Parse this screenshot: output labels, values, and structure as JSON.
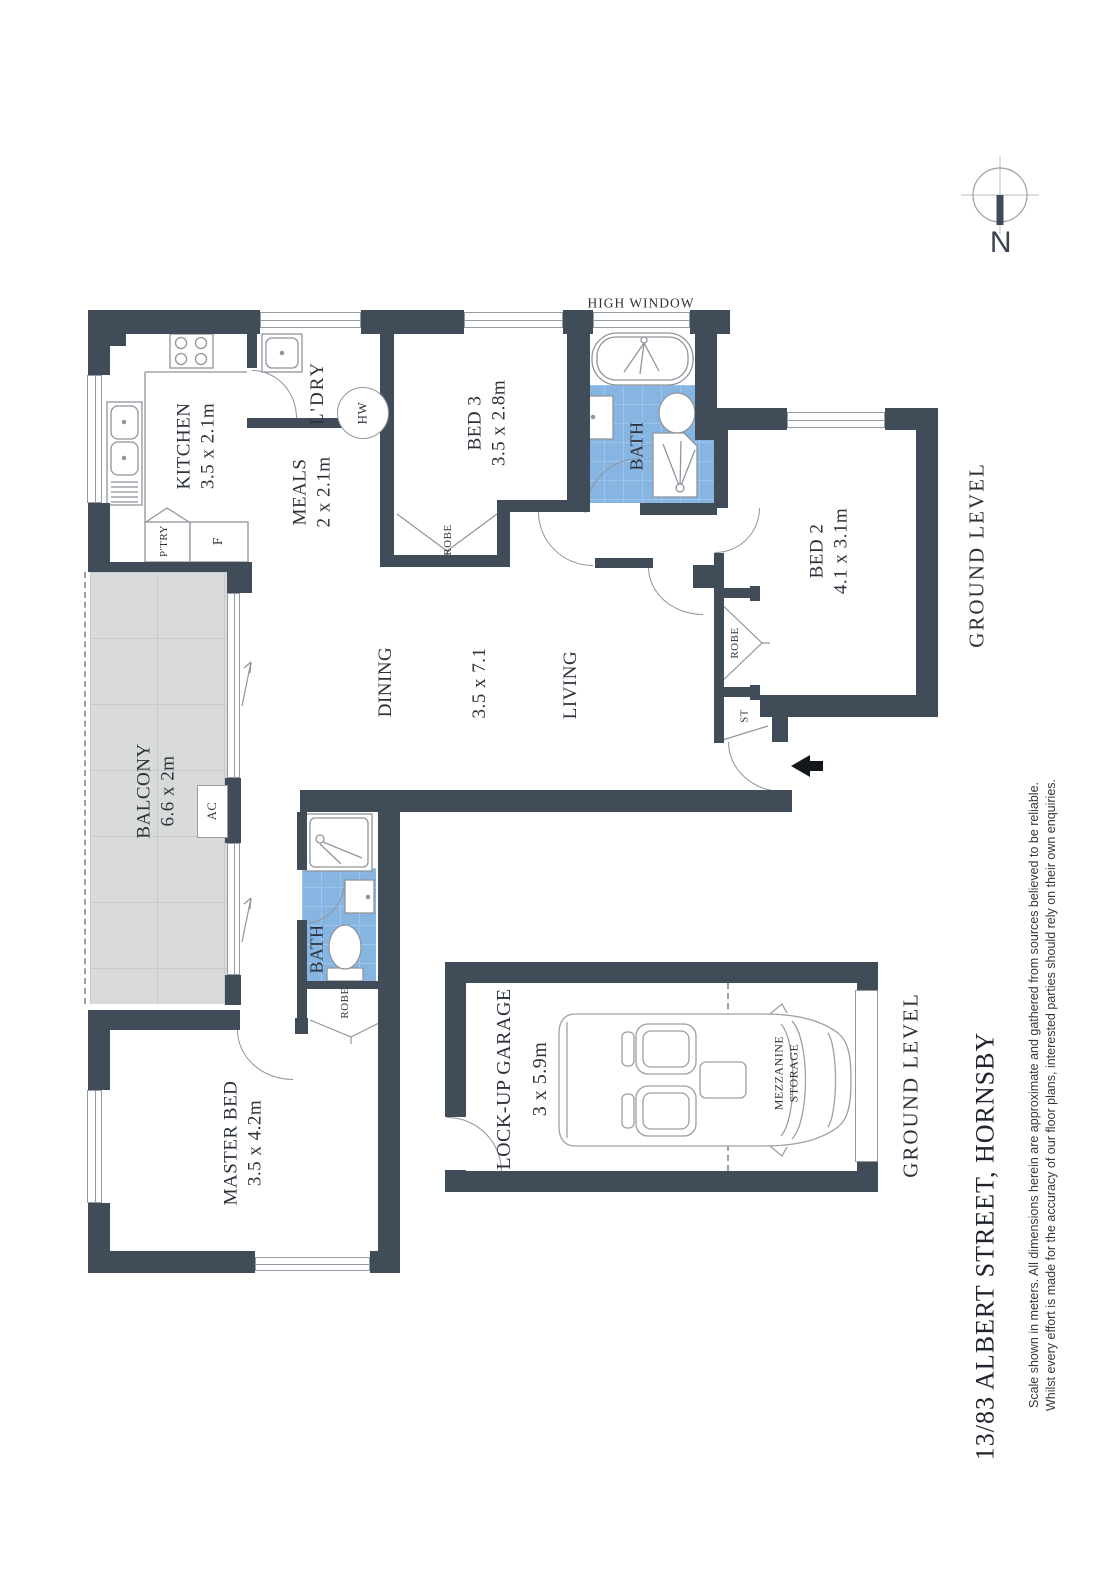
{
  "document": {
    "title": "13/83 ALBERT STREET, HORNSBY",
    "disclaimer_line1": "Scale shown in meters. All dimensions herein are approximate and gathered from sources believed to be reliable.",
    "disclaimer_line2": "Whilst every effort is made for the accuracy of our floor plans, interested parties should rely on their own enquiries."
  },
  "compass": {
    "north_label": "N"
  },
  "levels": {
    "unit_level_label": "GROUND LEVEL",
    "garage_level_label": "GROUND LEVEL"
  },
  "annotations": {
    "high_window": "HIGH WINDOW"
  },
  "rooms": {
    "kitchen": {
      "name": "KITCHEN",
      "dims": "3.5 x 2.1m"
    },
    "laundry": {
      "name": "L'DRY"
    },
    "meals": {
      "name": "MEALS",
      "dims": "2 x 2.1m"
    },
    "bed3": {
      "name": "BED 3",
      "dims": "3.5 x 2.8m"
    },
    "bath": {
      "name": "BATH"
    },
    "ensuite": {
      "name": "BATH"
    },
    "bed2": {
      "name": "BED 2",
      "dims": "4.1 x 3.1m"
    },
    "dining": {
      "name": "DINING"
    },
    "living": {
      "name": "LIVING"
    },
    "living_dining_dims": "3.5 x 7.1",
    "balcony": {
      "name": "BALCONY",
      "dims": "6.6 x 2m"
    },
    "master_bed": {
      "name": "MASTER BED",
      "dims": "3.5 x 4.2m"
    },
    "garage": {
      "name": "LOCK-UP GARAGE",
      "dims": "3 x 5.9m"
    },
    "mezzanine": {
      "line1": "MEZZANINE",
      "line2": "STORAGE"
    }
  },
  "fixtures": {
    "robe": "ROBE",
    "storage": "ST",
    "pantry": "P'TRY",
    "fridge": "F",
    "hot_water": "HW",
    "air_con": "AC"
  },
  "colors": {
    "wall": "#414c59",
    "fixture_line": "#8e959c",
    "bath_floor": "#87b5e2",
    "bath_floor_grid": "#9fc3ea",
    "balcony_floor": "#d9dbdb",
    "balcony_floor_grid": "#c8cacb",
    "text": "#2c323b",
    "entry_arrow": "#14171b"
  }
}
